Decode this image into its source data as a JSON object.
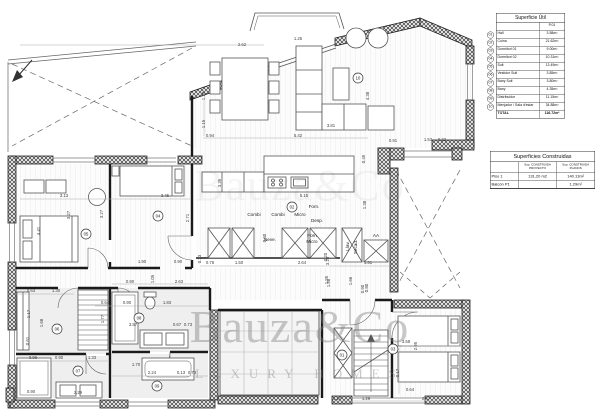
{
  "watermark": {
    "line1": "Bauza&Co",
    "line2": "LUXURY HOMES"
  },
  "tables": {
    "superficie_util": {
      "title": "Superficie Útil",
      "col_header": "P.01",
      "rows": [
        {
          "num": "01",
          "label": "Hall",
          "value": "3.58m²"
        },
        {
          "num": "02",
          "label": "Cuina",
          "value": "21.62m²"
        },
        {
          "num": "03",
          "label": "Dormitori 01",
          "value": "9.00m²"
        },
        {
          "num": "04",
          "label": "Dormitori 02",
          "value": "10.31m²"
        },
        {
          "num": "05",
          "label": "Suit",
          "value": "13.49m²"
        },
        {
          "num": "06",
          "label": "Vestidor Suit",
          "value": "3.85m²"
        },
        {
          "num": "07",
          "label": "Bany Suit",
          "value": "3.80m²"
        },
        {
          "num": "08",
          "label": "Bany",
          "value": "4.35m²"
        },
        {
          "num": "09",
          "label": "Distribuidor",
          "value": "11.15m²"
        },
        {
          "num": "10",
          "label": "Menjador / Sala d'estar",
          "value": "34.88m²"
        }
      ],
      "total_label": "TOTAL",
      "total_value": "116.72m²"
    },
    "superficies_construidas": {
      "title": "Superficies Construidas",
      "col_proyecto": "Sup. CONSTRUIDA PROYECTO",
      "col_planos": "Sup. CONSTRUIDA PLANOS",
      "rows": [
        {
          "label": "Piso 1",
          "proyecto": "131,20 m2",
          "planos": "140.13m²"
        },
        {
          "label": "Balcón P1",
          "proyecto": "",
          "planos": "1.29m²"
        }
      ]
    }
  },
  "plan": {
    "room_markers": [
      {
        "num": "01",
        "x": 342,
        "y": 355
      },
      {
        "num": "02",
        "x": 292,
        "y": 207
      },
      {
        "num": "03",
        "x": 393,
        "y": 349
      },
      {
        "num": "04",
        "x": 158,
        "y": 216
      },
      {
        "num": "05",
        "x": 86,
        "y": 234
      },
      {
        "num": "06",
        "x": 57,
        "y": 329
      },
      {
        "num": "07",
        "x": 78,
        "y": 371
      },
      {
        "num": "08",
        "x": 139,
        "y": 318
      },
      {
        "num": "09",
        "x": 157,
        "y": 386
      },
      {
        "num": "10",
        "x": 358,
        "y": 78
      }
    ],
    "labels": [
      {
        "t": "Combi",
        "x": 254,
        "y": 216
      },
      {
        "t": "Combi",
        "x": 278,
        "y": 216
      },
      {
        "t": "Micro",
        "x": 300,
        "y": 216
      },
      {
        "t": "Forn.",
        "x": 314,
        "y": 208
      },
      {
        "t": "Desp.",
        "x": 317,
        "y": 222
      },
      {
        "t": "Neve.",
        "x": 270,
        "y": 241
      },
      {
        "t": "Forn",
        "x": 312,
        "y": 237
      },
      {
        "t": "Micro",
        "x": 312,
        "y": 243
      },
      {
        "t": "Llav.",
        "x": 349,
        "y": 246,
        "r": -90
      },
      {
        "t": "Secad.",
        "x": 357,
        "y": 247,
        "r": -90
      },
      {
        "t": "AA",
        "x": 376,
        "y": 237
      }
    ],
    "dimensions": [
      {
        "t": "2.62",
        "x": 242,
        "y": 46
      },
      {
        "t": "1.25",
        "x": 298,
        "y": 40
      },
      {
        "t": "4.38",
        "x": 369,
        "y": 96,
        "r": -90
      },
      {
        "t": "3.81",
        "x": 331,
        "y": 127
      },
      {
        "t": "5.42",
        "x": 298,
        "y": 137
      },
      {
        "t": "0.94",
        "x": 210,
        "y": 137
      },
      {
        "t": "1.20",
        "x": 205,
        "y": 96,
        "r": -90
      },
      {
        "t": "1.15",
        "x": 205,
        "y": 124,
        "r": -90
      },
      {
        "t": "0.91",
        "x": 393,
        "y": 142
      },
      {
        "t": "1.53",
        "x": 428,
        "y": 141
      },
      {
        "t": "0.22",
        "x": 442,
        "y": 141
      },
      {
        "t": "0.49",
        "x": 365,
        "y": 159,
        "r": -90
      },
      {
        "t": "3.35",
        "x": 221,
        "y": 183,
        "r": -90
      },
      {
        "t": "5.15",
        "x": 304,
        "y": 197
      },
      {
        "t": "1.38",
        "x": 366,
        "y": 205,
        "r": -90
      },
      {
        "t": "0.60",
        "x": 266,
        "y": 238,
        "r": -90
      },
      {
        "t": "0.23",
        "x": 201,
        "y": 259,
        "r": -90
      },
      {
        "t": "0.76",
        "x": 210,
        "y": 264
      },
      {
        "t": "1.50",
        "x": 239,
        "y": 264
      },
      {
        "t": "2.64",
        "x": 302,
        "y": 264
      },
      {
        "t": "3.20",
        "x": 329,
        "y": 261,
        "r": -90
      },
      {
        "t": "1.51",
        "x": 368,
        "y": 264
      },
      {
        "t": "0.20",
        "x": 327,
        "y": 257,
        "r": -90
      },
      {
        "t": "1.86",
        "x": 330,
        "y": 283,
        "r": -90
      },
      {
        "t": "1.66",
        "x": 352,
        "y": 281,
        "r": -90
      },
      {
        "t": "0.90",
        "x": 364,
        "y": 289,
        "r": -90
      },
      {
        "t": "3.13",
        "x": 64,
        "y": 197
      },
      {
        "t": "3.45",
        "x": 165,
        "y": 197
      },
      {
        "t": "4.41",
        "x": 40,
        "y": 231,
        "r": -90
      },
      {
        "t": "3.27",
        "x": 70,
        "y": 215,
        "r": -90
      },
      {
        "t": "3.27",
        "x": 103,
        "y": 214,
        "r": -90
      },
      {
        "t": "2.71",
        "x": 189,
        "y": 218,
        "r": -90
      },
      {
        "t": "1.90",
        "x": 142,
        "y": 263
      },
      {
        "t": "0.90",
        "x": 178,
        "y": 263
      },
      {
        "t": "0.63",
        "x": 31,
        "y": 292
      },
      {
        "t": "1.30",
        "x": 56,
        "y": 292
      },
      {
        "t": "0.90",
        "x": 130,
        "y": 283
      },
      {
        "t": "2.63",
        "x": 179,
        "y": 283
      },
      {
        "t": "1.05",
        "x": 154,
        "y": 279,
        "r": -90
      },
      {
        "t": "0.64",
        "x": 105,
        "y": 304
      },
      {
        "t": "0.90",
        "x": 127,
        "y": 304
      },
      {
        "t": "1.83",
        "x": 167,
        "y": 304
      },
      {
        "t": "1.77",
        "x": 104,
        "y": 319,
        "r": -90
      },
      {
        "t": "3.57",
        "x": 133,
        "y": 326
      },
      {
        "t": "0.67",
        "x": 177,
        "y": 326
      },
      {
        "t": "0.73",
        "x": 188,
        "y": 326
      },
      {
        "t": "1.17",
        "x": 30,
        "y": 314,
        "r": -90
      },
      {
        "t": "1.68",
        "x": 43,
        "y": 323,
        "r": -90
      },
      {
        "t": "0.61",
        "x": 29,
        "y": 341,
        "r": -90
      },
      {
        "t": "0.96",
        "x": 33,
        "y": 359
      },
      {
        "t": "0.90",
        "x": 59,
        "y": 359
      },
      {
        "t": "1.33",
        "x": 92,
        "y": 359
      },
      {
        "t": "1.70",
        "x": 136,
        "y": 366
      },
      {
        "t": "2.24",
        "x": 152,
        "y": 374
      },
      {
        "t": "0.13",
        "x": 181,
        "y": 374
      },
      {
        "t": "0.73",
        "x": 192,
        "y": 374
      },
      {
        "t": "2.29",
        "x": 78,
        "y": 394
      },
      {
        "t": "0.90",
        "x": 31,
        "y": 393
      },
      {
        "t": "1.95",
        "x": 328,
        "y": 280,
        "r": -90
      },
      {
        "t": "0.80",
        "x": 368,
        "y": 288,
        "r": -90
      },
      {
        "t": "3.58",
        "x": 406,
        "y": 343
      },
      {
        "t": "2.95",
        "x": 417,
        "y": 346,
        "r": -90
      },
      {
        "t": "0.17",
        "x": 399,
        "y": 373,
        "r": -90
      },
      {
        "t": "0.64",
        "x": 410,
        "y": 391
      },
      {
        "t": "1.10",
        "x": 337,
        "y": 400
      },
      {
        "t": "1.29",
        "x": 366,
        "y": 400
      },
      {
        "t": "2.47",
        "x": 426,
        "y": 400
      }
    ]
  }
}
